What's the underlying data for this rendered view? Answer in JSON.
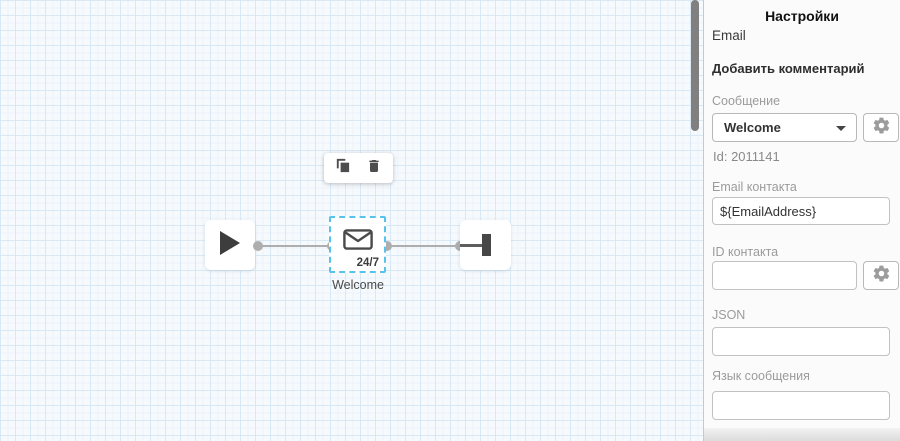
{
  "canvas": {
    "toolbar": {
      "copy_icon": "copy-duplicate",
      "delete_icon": "trash"
    },
    "nodes": {
      "start": {
        "type": "start",
        "icon": "play"
      },
      "email": {
        "icon": "envelope",
        "badge": "24/7",
        "caption": "Welcome",
        "selected": true
      },
      "end": {
        "type": "end",
        "icon": "end-bar"
      }
    }
  },
  "panel": {
    "title": "Настройки",
    "subtitle": "Email",
    "add_comment": "Добавить комментарий",
    "message": {
      "label": "Сообщение",
      "value": "Welcome",
      "id_text": "Id: 2011141",
      "gear_icon": "gear"
    },
    "contact_email": {
      "label": "Email контакта",
      "value": "${EmailAddress}"
    },
    "contact_id": {
      "label": "ID контакта",
      "value": "",
      "gear_icon": "gear"
    },
    "json": {
      "label": "JSON",
      "value": ""
    },
    "language": {
      "label": "Язык сообщения",
      "value": ""
    }
  },
  "colors": {
    "canvas_bg": "#f6fafd",
    "grid_line": "#d9e8f5",
    "selection_dashed": "#58c3ea",
    "edge_gray": "#aeaeae",
    "node_glyph": "#474747",
    "panel_bg": "#fbfbfb",
    "label_gray": "#9b9b9b",
    "input_border": "#c2c2c2",
    "scrollbar_thumb": "#808080"
  }
}
